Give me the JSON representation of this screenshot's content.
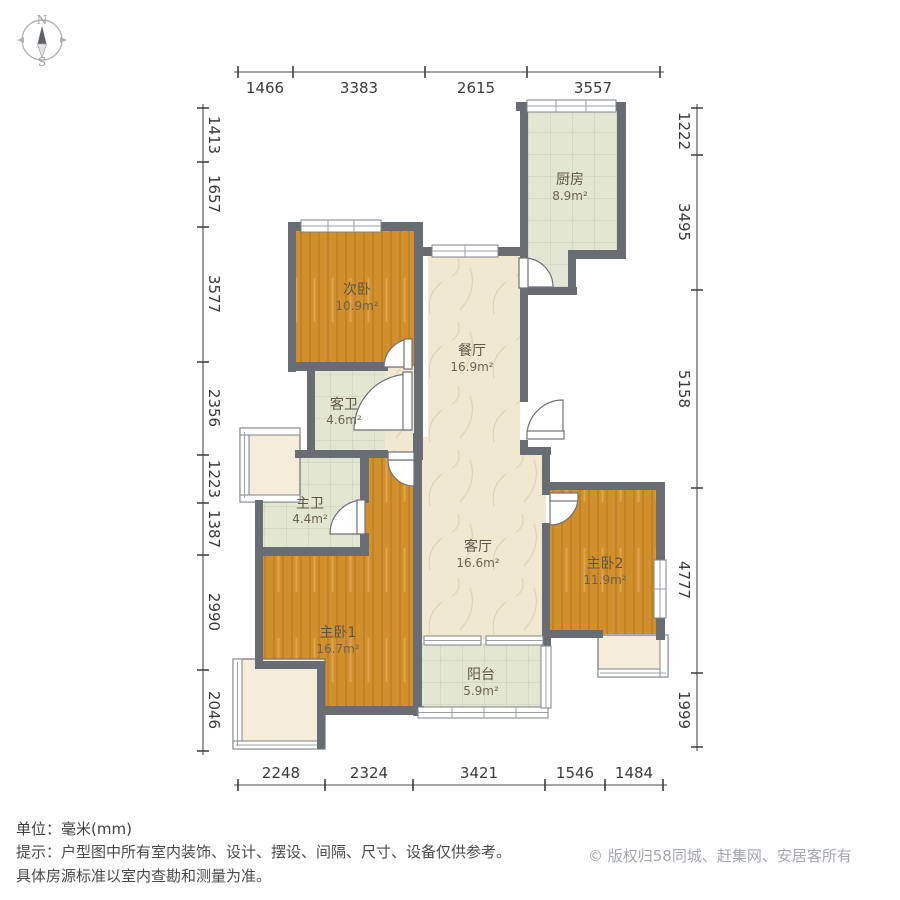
{
  "compass": {
    "north": "N",
    "south": "S"
  },
  "dims": {
    "top": [
      "1466",
      "3383",
      "2615",
      "3557"
    ],
    "bottom": [
      "2248",
      "2324",
      "3421",
      "1546",
      "1484"
    ],
    "left": [
      "1413",
      "1657",
      "3577",
      "2356",
      "1223",
      "1387",
      "2990",
      "2046"
    ],
    "right": [
      "1222",
      "3495",
      "5158",
      "4777",
      "1999"
    ]
  },
  "rooms": [
    {
      "name": "厨房",
      "area": "8.9m²"
    },
    {
      "name": "次卧",
      "area": "10.9m²"
    },
    {
      "name": "餐厅",
      "area": "16.9m²"
    },
    {
      "name": "客卫",
      "area": "4.6m²"
    },
    {
      "name": "主卫",
      "area": "4.4m²"
    },
    {
      "name": "客厅",
      "area": "16.6m²"
    },
    {
      "name": "主卧2",
      "area": "11.9m²"
    },
    {
      "name": "主卧1",
      "area": "16.7m²"
    },
    {
      "name": "阳台",
      "area": "5.9m²"
    }
  ],
  "footer": {
    "unit_line": "单位：毫米(mm)",
    "tip_line1": "提示：户型图中所有室内装饰、设计、摆设、间隔、尺寸、设备仅供参考。",
    "tip_line2": "具体房源标准以室内查勘和测量为准。",
    "copyright": "© 版权归58同城、赶集网、安居客所有"
  },
  "colors": {
    "wall": "#686d73",
    "bedroom_floor": "#d2902d",
    "living_floor": "#f0e8d1",
    "tile_floor": "#e3e6d3",
    "bay_floor": "#f5edda"
  }
}
